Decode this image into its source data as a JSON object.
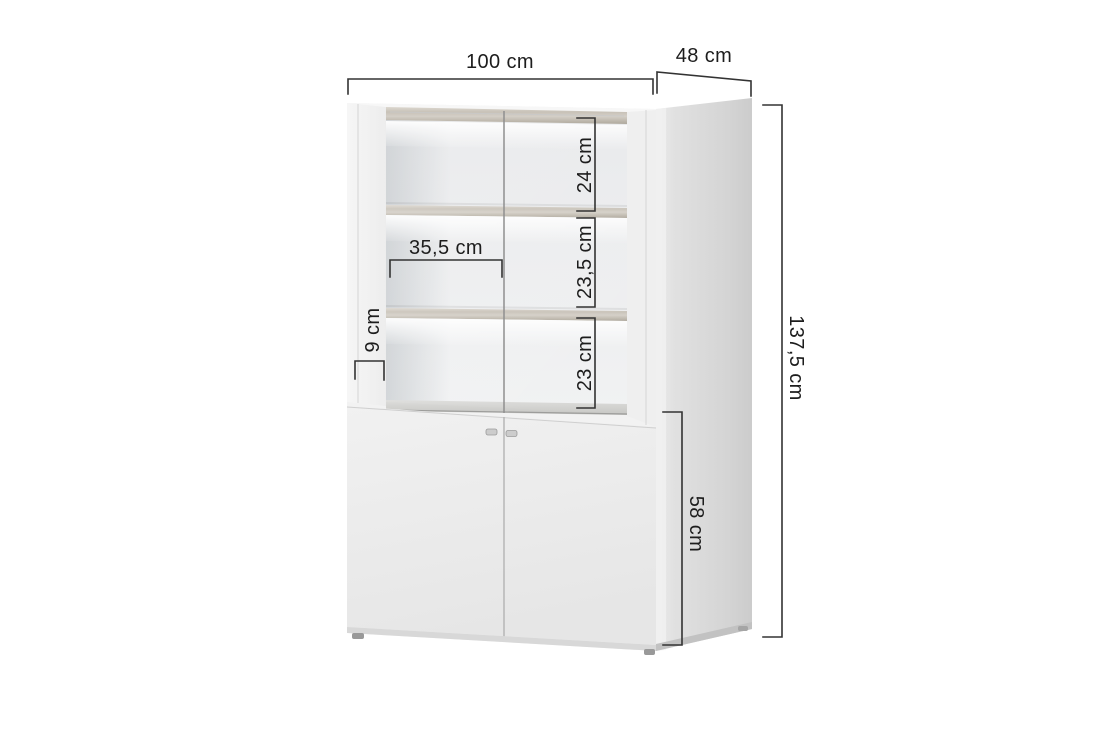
{
  "diagram": {
    "subject": "two-door display cabinet with glass doors, LED-lit shelves and lower storage cabinet",
    "view": "three-quarter product render with dimension callouts",
    "dimensions": {
      "overall_width": "100 cm",
      "overall_depth": "48 cm",
      "overall_height": "137,5 cm",
      "top_compartment_height": "24 cm",
      "middle_compartment_height": "23,5 cm",
      "lower_compartment_height": "23 cm",
      "inner_shelf_width": "35,5 cm",
      "side_frame_width": "9 cm",
      "base_cabinet_height": "58 cm"
    },
    "colors": {
      "background": "#ffffff",
      "dimension_line": "#333333",
      "label_text": "#1d1d1d",
      "cabinet_front": "#f2f2f2",
      "cabinet_side": "#d6d6d6",
      "wood_board": "#c7c1b7",
      "led_glow": "#ffffff"
    }
  }
}
